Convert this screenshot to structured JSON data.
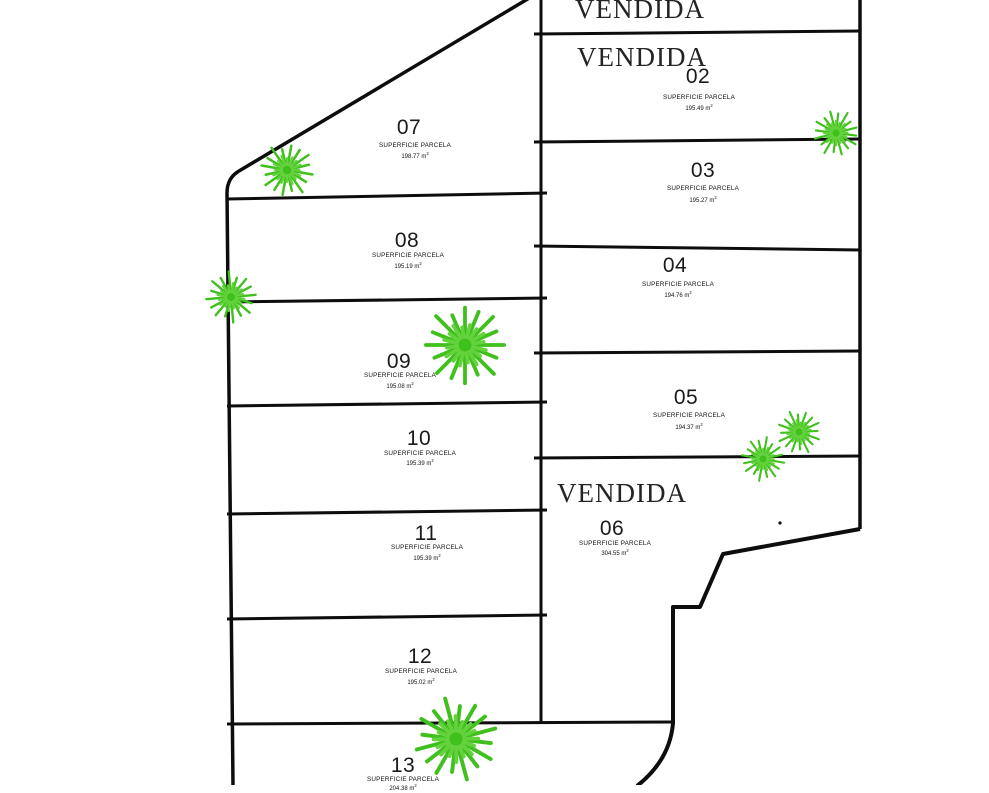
{
  "plan_title": "parcel-site-plan",
  "labels": {
    "vendida": "VENDIDA",
    "superficie": "SUPERFICIE PARCELA",
    "unit": " m",
    "sup": "2"
  },
  "colors": {
    "line": "#0d0d0d",
    "tree_green": "#3fc01d",
    "tree_green_light": "#63d23c",
    "background": "#ffffff"
  },
  "parcels": [
    {
      "sold": true
    },
    {
      "number": "02",
      "area": "195.49",
      "sold": true
    },
    {
      "number": "03",
      "area": "195.27",
      "sold": false
    },
    {
      "number": "04",
      "area": "194.76",
      "sold": false
    },
    {
      "number": "05",
      "area": "194.37",
      "sold": false
    },
    {
      "number": "06",
      "area": "304.55",
      "sold": true
    },
    {
      "number": "07",
      "area": "198.77",
      "sold": false
    },
    {
      "number": "08",
      "area": "195.19",
      "sold": false
    },
    {
      "number": "09",
      "area": "195.08",
      "sold": false
    },
    {
      "number": "10",
      "area": "195.39",
      "sold": false
    },
    {
      "number": "11",
      "area": "195.39",
      "sold": false
    },
    {
      "number": "12",
      "area": "195.02",
      "sold": false
    },
    {
      "number": "13",
      "area": "204.38",
      "sold": false
    }
  ]
}
